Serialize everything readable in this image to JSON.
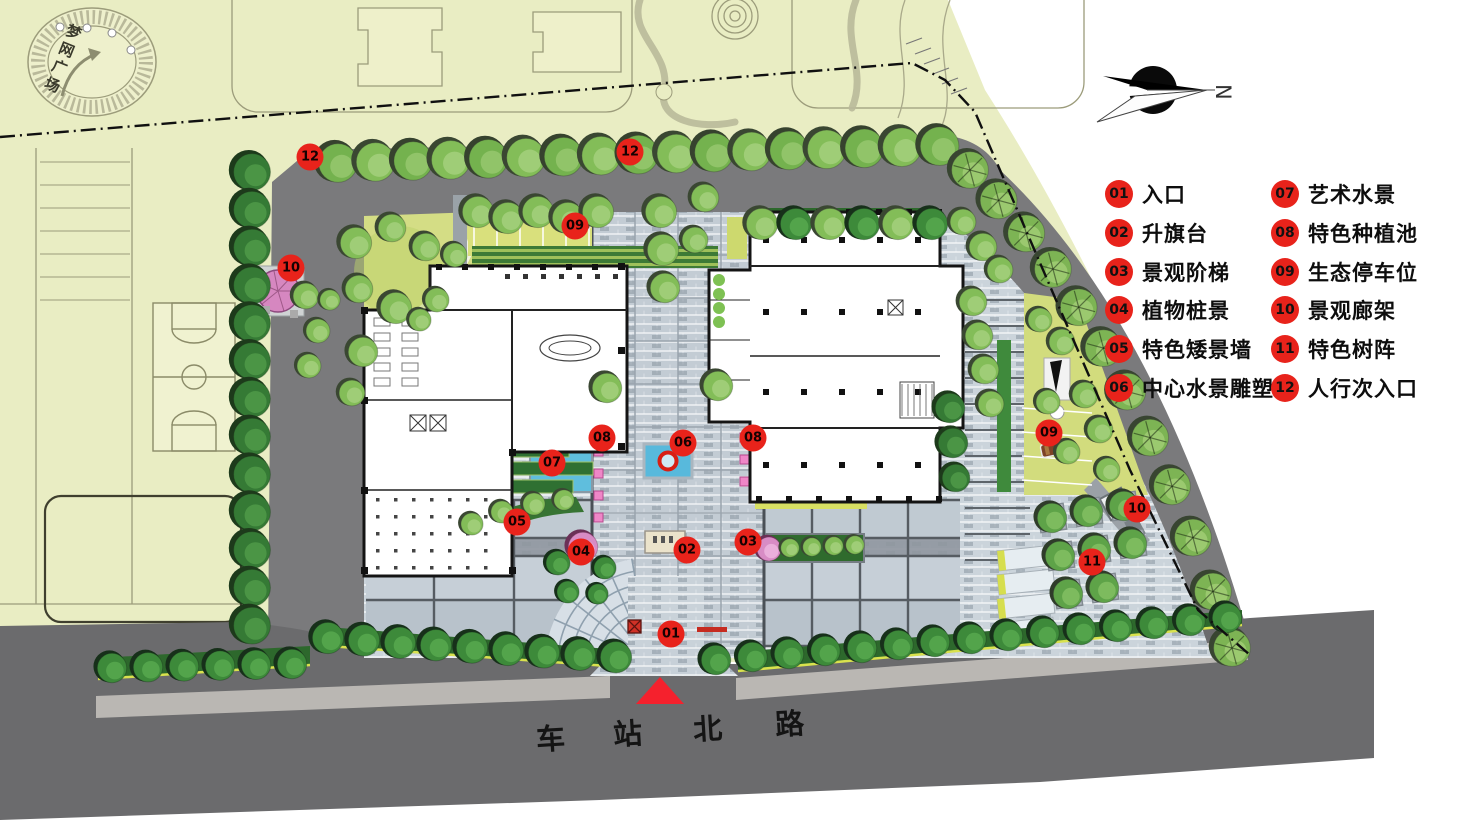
{
  "context": {
    "plaza_label": "梦网广场"
  },
  "north": {
    "label": "N"
  },
  "road": {
    "name": "车站北路",
    "chars": [
      "车",
      "站",
      "北",
      "路"
    ]
  },
  "legend": {
    "items": [
      {
        "num": "01",
        "label": "入口"
      },
      {
        "num": "02",
        "label": "升旗台"
      },
      {
        "num": "03",
        "label": "景观阶梯"
      },
      {
        "num": "04",
        "label": "植物桩景"
      },
      {
        "num": "05",
        "label": "特色矮景墙"
      },
      {
        "num": "06",
        "label": "中心水景雕塑"
      },
      {
        "num": "07",
        "label": "艺术水景"
      },
      {
        "num": "08",
        "label": "特色种植池"
      },
      {
        "num": "09",
        "label": "生态停车位"
      },
      {
        "num": "10",
        "label": "景观廊架"
      },
      {
        "num": "11",
        "label": "特色树阵"
      },
      {
        "num": "12",
        "label": "人行次入口"
      }
    ]
  },
  "markers": [
    {
      "num": "12",
      "x": 310,
      "y": 157
    },
    {
      "num": "12",
      "x": 630,
      "y": 152
    },
    {
      "num": "09",
      "x": 575,
      "y": 226
    },
    {
      "num": "10",
      "x": 291,
      "y": 268
    },
    {
      "num": "08",
      "x": 602,
      "y": 438
    },
    {
      "num": "06",
      "x": 683,
      "y": 443
    },
    {
      "num": "08",
      "x": 753,
      "y": 438
    },
    {
      "num": "07",
      "x": 552,
      "y": 463
    },
    {
      "num": "09",
      "x": 1049,
      "y": 433
    },
    {
      "num": "05",
      "x": 517,
      "y": 522
    },
    {
      "num": "04",
      "x": 581,
      "y": 552
    },
    {
      "num": "02",
      "x": 687,
      "y": 550
    },
    {
      "num": "03",
      "x": 748,
      "y": 542
    },
    {
      "num": "10",
      "x": 1137,
      "y": 509
    },
    {
      "num": "11",
      "x": 1092,
      "y": 562
    },
    {
      "num": "01",
      "x": 671,
      "y": 634
    }
  ],
  "colors": {
    "marker_red": "#e8231b",
    "accent_red": "#f5212d",
    "context_pale": "#e9edc3",
    "road_dark": "#6b6b6d",
    "road_mid": "#7a7a7c",
    "paving": "#cbd4db",
    "water_blue": "#5fbedd",
    "lawn": "#d5de85",
    "hedge_green": "#2d682c",
    "pink": "#d98ac4"
  }
}
